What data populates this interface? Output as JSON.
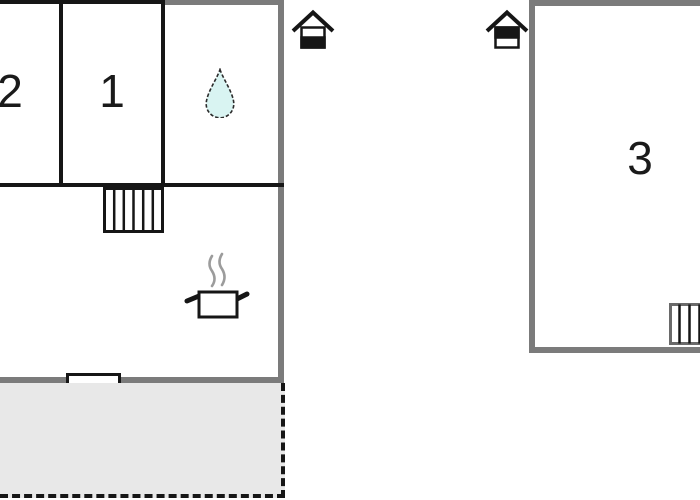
{
  "plan_title": "holiday home floor plan",
  "colors": {
    "background": "#ffffff",
    "exterior_wall": "#7b7b7b",
    "interior_wall": "#161616",
    "terrace_fill": "#e8e8e8",
    "water_drop_fill": "#d9f4f2",
    "steam": "#9c9c9c"
  },
  "building_left": {
    "room2_label": "2",
    "room1_label": "1",
    "icons": {
      "bathroom": "water-drop-icon",
      "stairs": "staircase-icon (6 treads)",
      "kitchen": "cooking-pot-with-steam-icon",
      "window": "window-marker",
      "entrance": "entrance-house-icon (door at bottom)"
    },
    "terrace": "gray terrace with dashed boundary"
  },
  "building_right": {
    "room3_label": "3",
    "icons": {
      "stairs": "staircase-icon (cut at right edge)",
      "entrance": "entrance-house-icon (door at top)"
    }
  }
}
